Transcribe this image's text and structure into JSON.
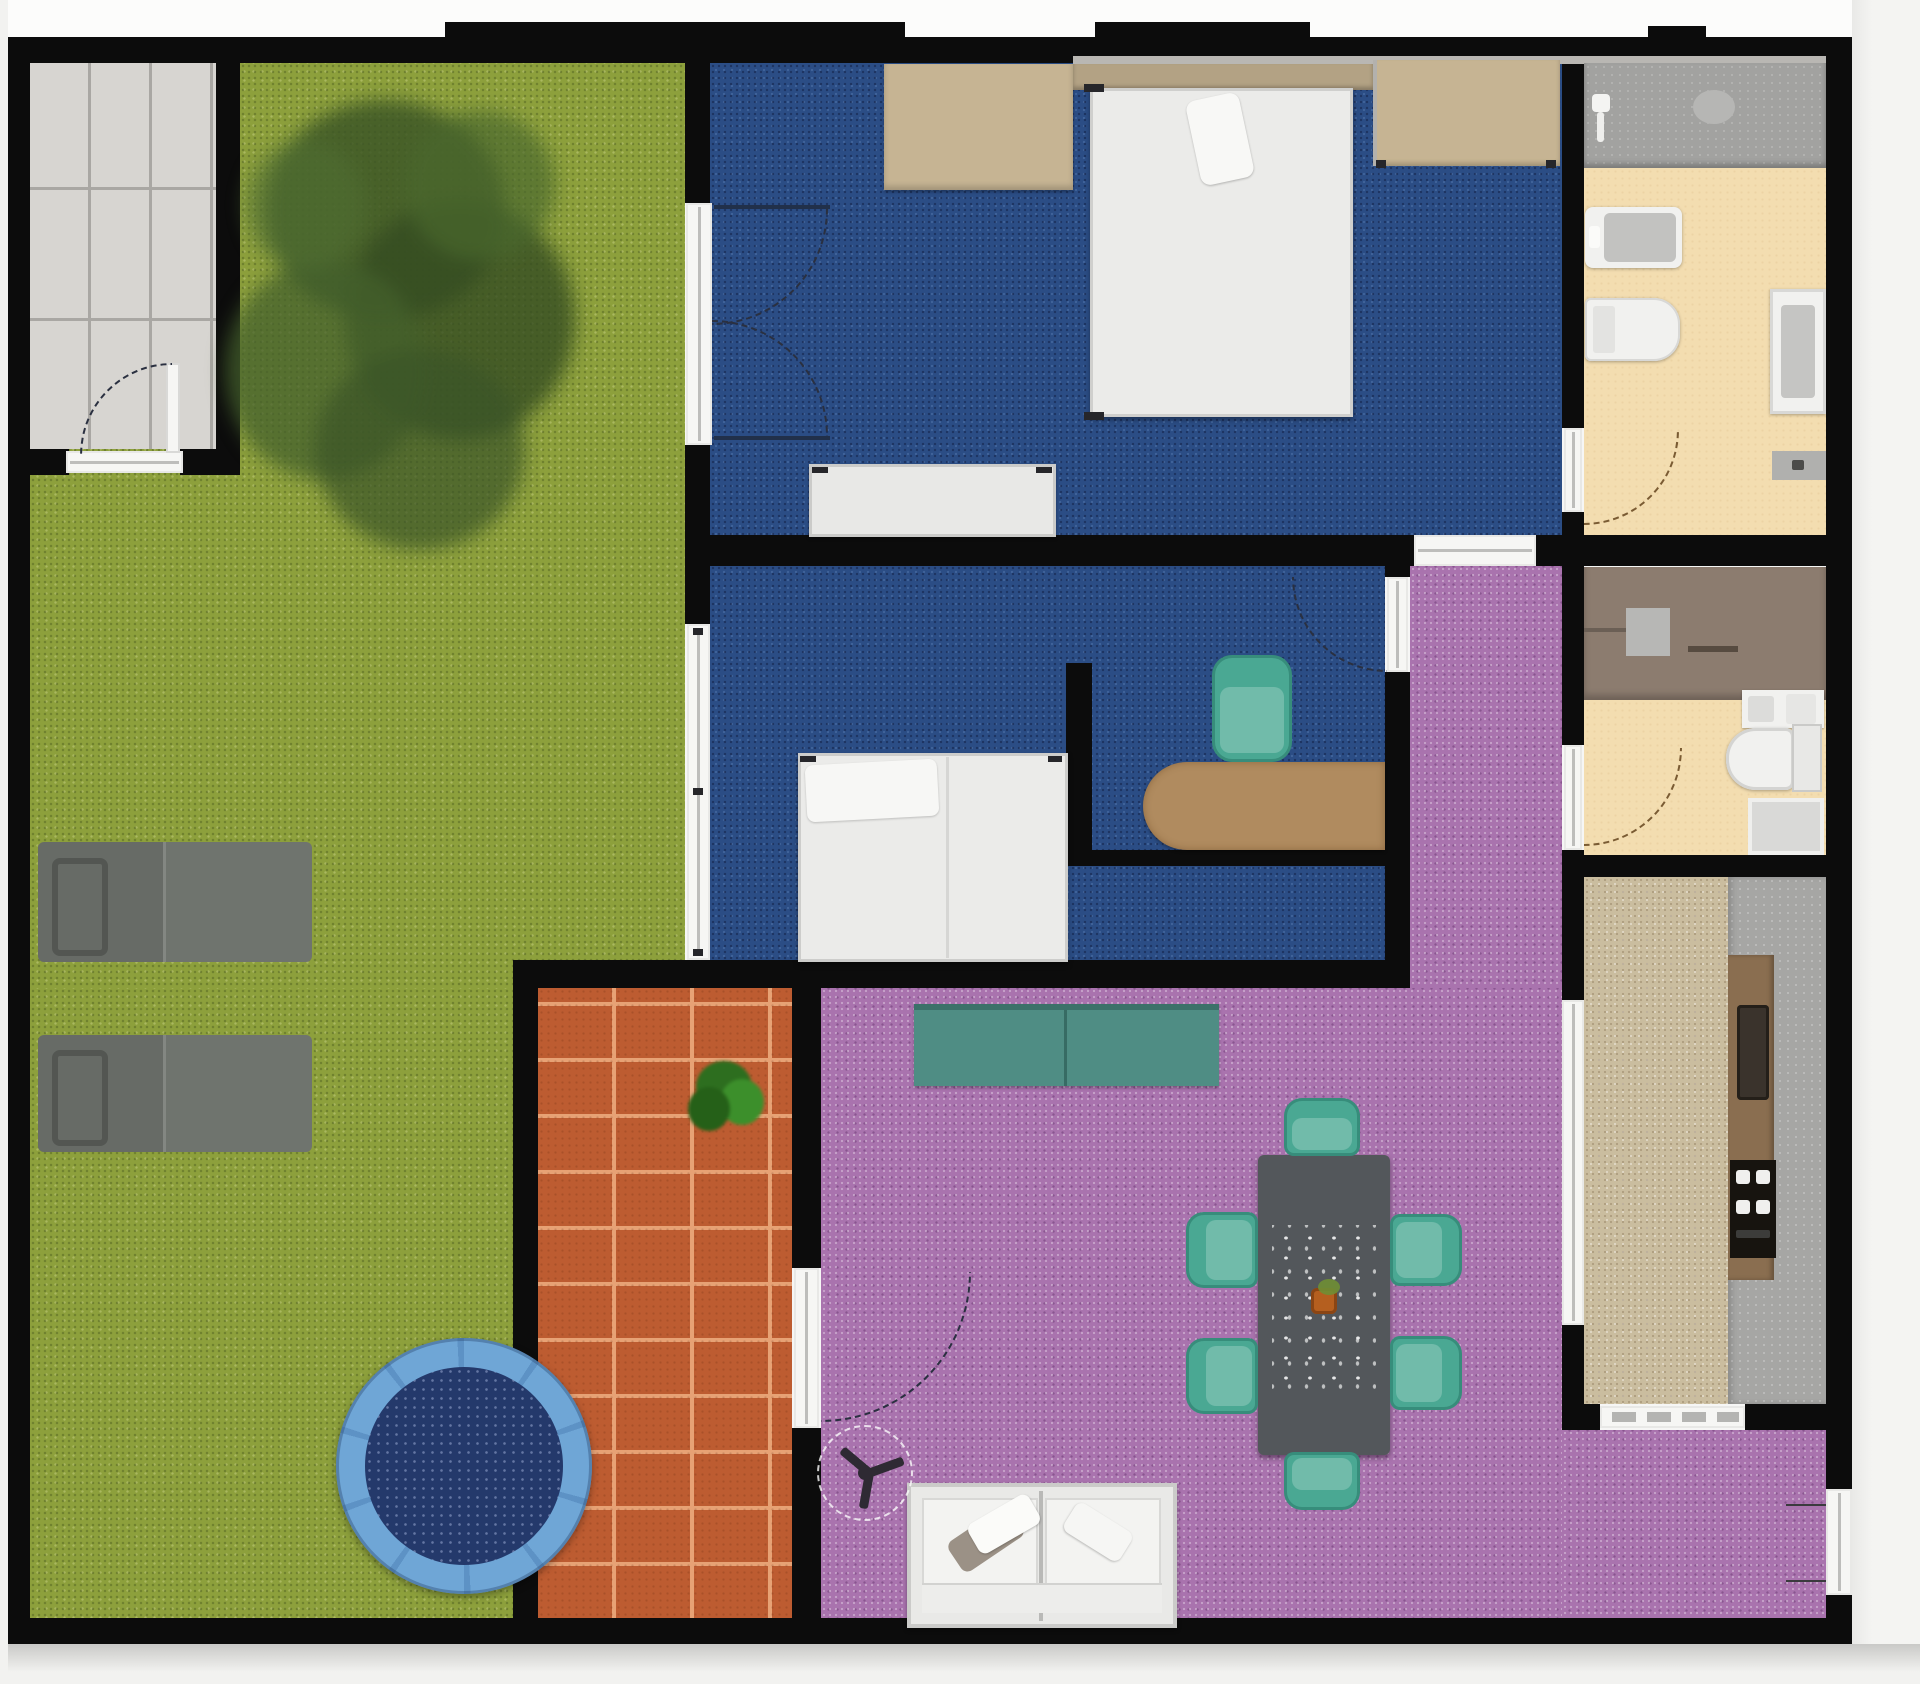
{
  "app": {
    "type": "floor-plan-render",
    "description": "Top-down 2D rendered floor plan of a house with garden, round pool, brick patio, two blue-carpet bedrooms, purple living-dining room, hallway, two bathrooms and a kitchen"
  },
  "palette": {
    "wall": "#0c0c0c",
    "margin_bg": "#f1f1ef",
    "grass": "#8da03c",
    "tree_green": "#3c5626",
    "paver": "#d7d5d1",
    "paver_joint": "#a9a7a3",
    "blue_floor": "#2b4d85",
    "purple_floor": "#a973ae",
    "patio_brick": "#bd5c31",
    "patio_grout": "#e7a275",
    "bath_floor": "#f3ddb0",
    "shower_gray": "#a2a2a0",
    "shower_brown": "#8c7c6f",
    "kitchen_floor": "#cabd9f",
    "counter_gray": "#a6a6a4",
    "counter_wood": "#8a6e50",
    "stove_black": "#17140f",
    "fixture_white": "#f1f1ef",
    "fixture_gray": "#c2c2c0",
    "door_white": "#f6f6f4",
    "door_gray": "#bdbdbb",
    "teal_chair": "#4aa893",
    "teal_sofa": "#4f8d84",
    "table_gray": "#53575b",
    "wood_desk": "#b08b5f",
    "tan_furniture": "#c6b493",
    "headboard_tan": "#b3a284",
    "mattress_white": "#ebebe9",
    "lounger_gray": "#6f746e",
    "pool_ring": "#6fa6d6",
    "pool_water": "#24396b",
    "plant_green": "#2e7a25",
    "fan_dark": "#2e2a33",
    "arc": "#2a3040",
    "arc_brown": "#7a5b33"
  },
  "rooms": [
    {
      "id": "yard",
      "label": "Garden lawn"
    },
    {
      "id": "shed",
      "label": "Paved entry room"
    },
    {
      "id": "bedroom-1",
      "label": "Master bedroom"
    },
    {
      "id": "bedroom-2",
      "label": "Second bedroom with study nook"
    },
    {
      "id": "hallway",
      "label": "Hallway"
    },
    {
      "id": "living-dining",
      "label": "Living and dining room"
    },
    {
      "id": "patio",
      "label": "Brick patio"
    },
    {
      "id": "bathroom-1",
      "label": "En-suite bathroom"
    },
    {
      "id": "bathroom-2",
      "label": "Second bathroom"
    },
    {
      "id": "kitchen",
      "label": "Kitchen"
    }
  ],
  "furniture": {
    "tree": "Large garden tree",
    "lounger_1": "Sun lounger",
    "lounger_2": "Sun lounger",
    "pool": "Round above-ground pool",
    "patio_plant": "Potted shrub",
    "dresser_1": "Wardrobe dresser",
    "bed_1": "Double bed",
    "closet_1": "Built-in closet",
    "sideboard_1": "Low white dresser",
    "bed_2": "Single bed",
    "desk": "Study desk",
    "desk_chair": "Desk chair",
    "bench": "Teal bench sofa",
    "dining_table": "Dining table with flower decor",
    "dining_chairs": "Six teal dining chairs",
    "sofa": "White two-seat sofa",
    "ceiling_fan": "Ceiling fan",
    "shower_1": "Walk-in shower",
    "bathtub_1": "Bathtub",
    "toilet_1": "Toilet",
    "vanity_1": "Washbasin vanity",
    "shower_2": "Shower area",
    "sink_2": "Double washbasin",
    "toilet_2": "Toilet",
    "shower_tray_2": "Shower tray",
    "kitchen_counter": "Kitchen counter",
    "kitchen_sink": "Kitchen sink",
    "stove": "Cooktop with burners"
  }
}
